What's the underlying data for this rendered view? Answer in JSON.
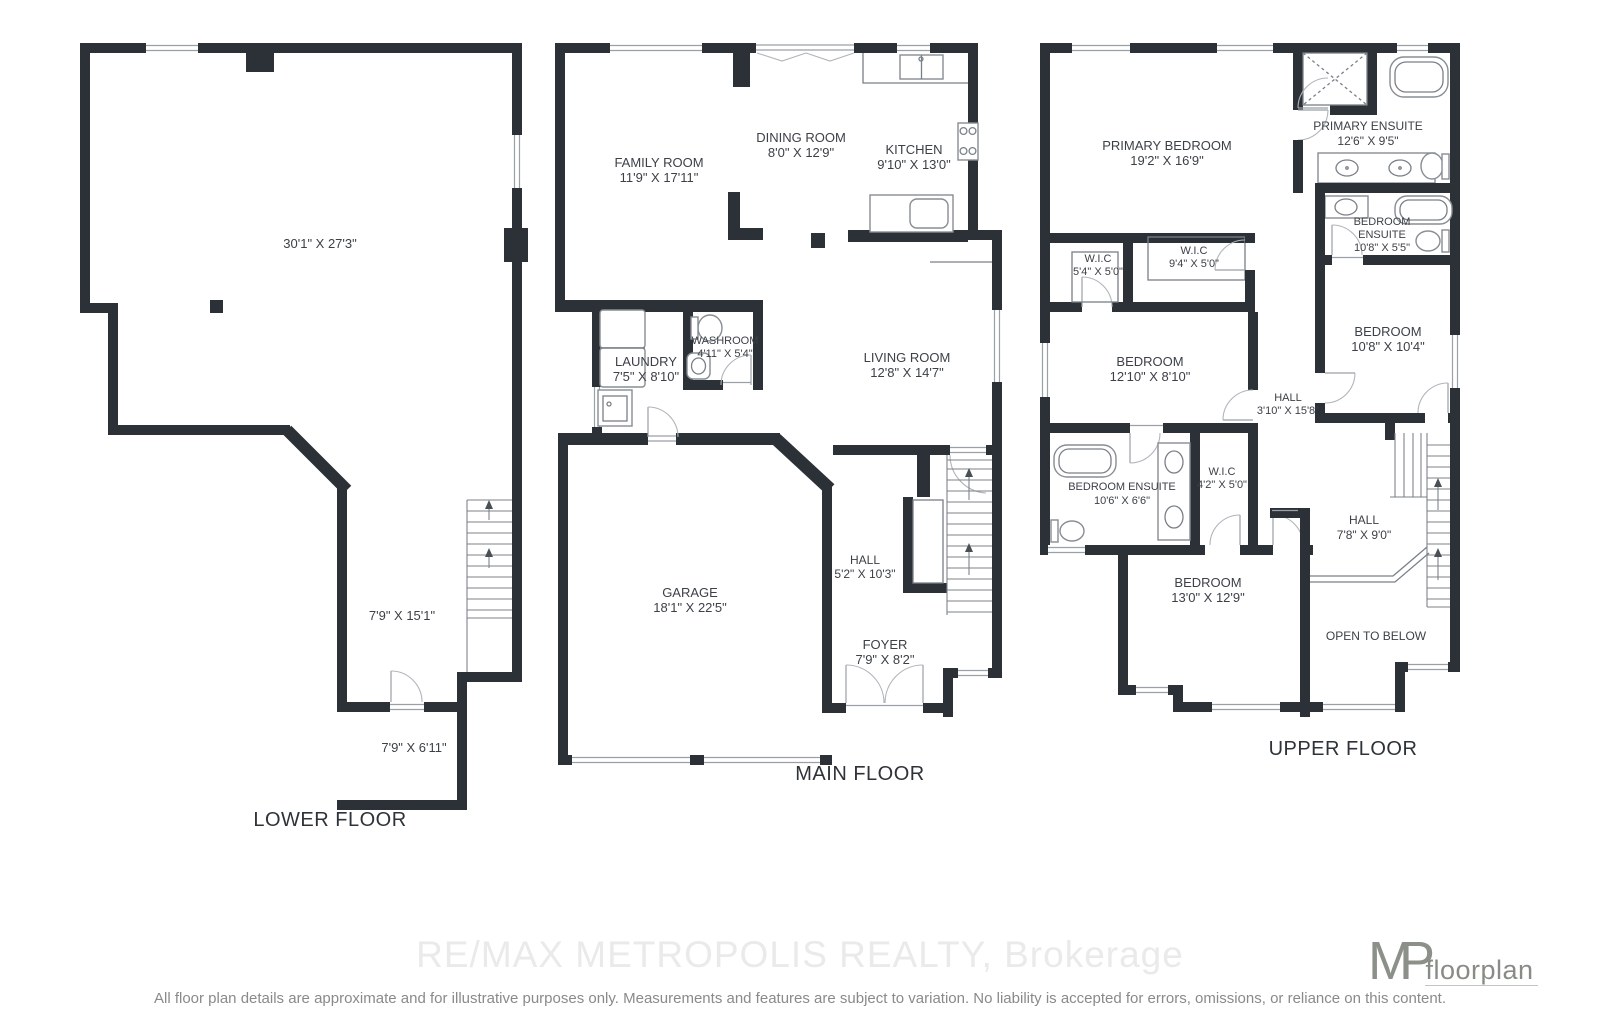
{
  "floors": {
    "lower": {
      "title": "LOWER FLOOR",
      "rooms": {
        "rec": {
          "dims": "30'1\" X 27'3\""
        },
        "hall": {
          "dims": "7'9\" X 15'1\""
        },
        "storage": {
          "dims": "7'9\" X 6'11\""
        }
      }
    },
    "main": {
      "title": "MAIN FLOOR",
      "rooms": {
        "family": {
          "label": "FAMILY ROOM",
          "dims": "11'9\" X 17'11\""
        },
        "dining": {
          "label": "DINING ROOM",
          "dims": "8'0\" X 12'9\""
        },
        "kitchen": {
          "label": "KITCHEN",
          "dims": "9'10\" X 13'0\""
        },
        "laundry": {
          "label": "LAUNDRY",
          "dims": "7'5\" X 8'10\""
        },
        "washroom": {
          "label": "WASHROOM",
          "dims": "4'11\" X 5'4\""
        },
        "living": {
          "label": "LIVING ROOM",
          "dims": "12'8\" X 14'7\""
        },
        "garage": {
          "label": "GARAGE",
          "dims": "18'1\" X 22'5\""
        },
        "hall": {
          "label": "HALL",
          "dims": "5'2\" X 10'3\""
        },
        "foyer": {
          "label": "FOYER",
          "dims": "7'9\" X 8'2\""
        }
      }
    },
    "upper": {
      "title": "UPPER FLOOR",
      "rooms": {
        "primary": {
          "label": "PRIMARY BEDROOM",
          "dims": "19'2\" X 16'9\""
        },
        "primary_ensuite": {
          "label": "PRIMARY ENSUITE",
          "dims": "12'6\" X 9'5\""
        },
        "bedroom_ensuite_r": {
          "label1": "BEDROOM",
          "label2": "ENSUITE",
          "dims": "10'8\" X 5'5\""
        },
        "wic_small": {
          "label": "W.I.C",
          "dims": "5'4\" X 5'0\""
        },
        "wic_big": {
          "label": "W.I.C",
          "dims": "9'4\" X 5'0\""
        },
        "bedroom2": {
          "label": "BEDROOM",
          "dims": "12'10\" X 8'10\""
        },
        "bedroom3": {
          "label": "BEDROOM",
          "dims": "10'8\" X 10'4\""
        },
        "hall_mid": {
          "label": "HALL",
          "dims": "3'10\" X 15'8\""
        },
        "bedroom_ensuite_l": {
          "label": "BEDROOM ENSUITE",
          "dims": "10'6\" X 6'6\""
        },
        "wic_42": {
          "label": "W.I.C",
          "dims": "4'2\" X 5'0\""
        },
        "hall_low": {
          "label": "HALL",
          "dims": "7'8\" X 9'0\""
        },
        "bedroom4": {
          "label": "BEDROOM",
          "dims": "13'0\" X 12'9\""
        },
        "open_below": {
          "label": "OPEN TO BELOW"
        }
      }
    }
  },
  "footer": {
    "watermark": "RE/MAX METROPOLIS REALTY, Brokerage",
    "logo_initials": "MP",
    "logo_text": "floorplan",
    "disclaimer": "All floor plan details are approximate and for illustrative purposes only. Measurements and features are subject to variation. No liability is accepted for errors, omissions, or reliance on this content."
  }
}
